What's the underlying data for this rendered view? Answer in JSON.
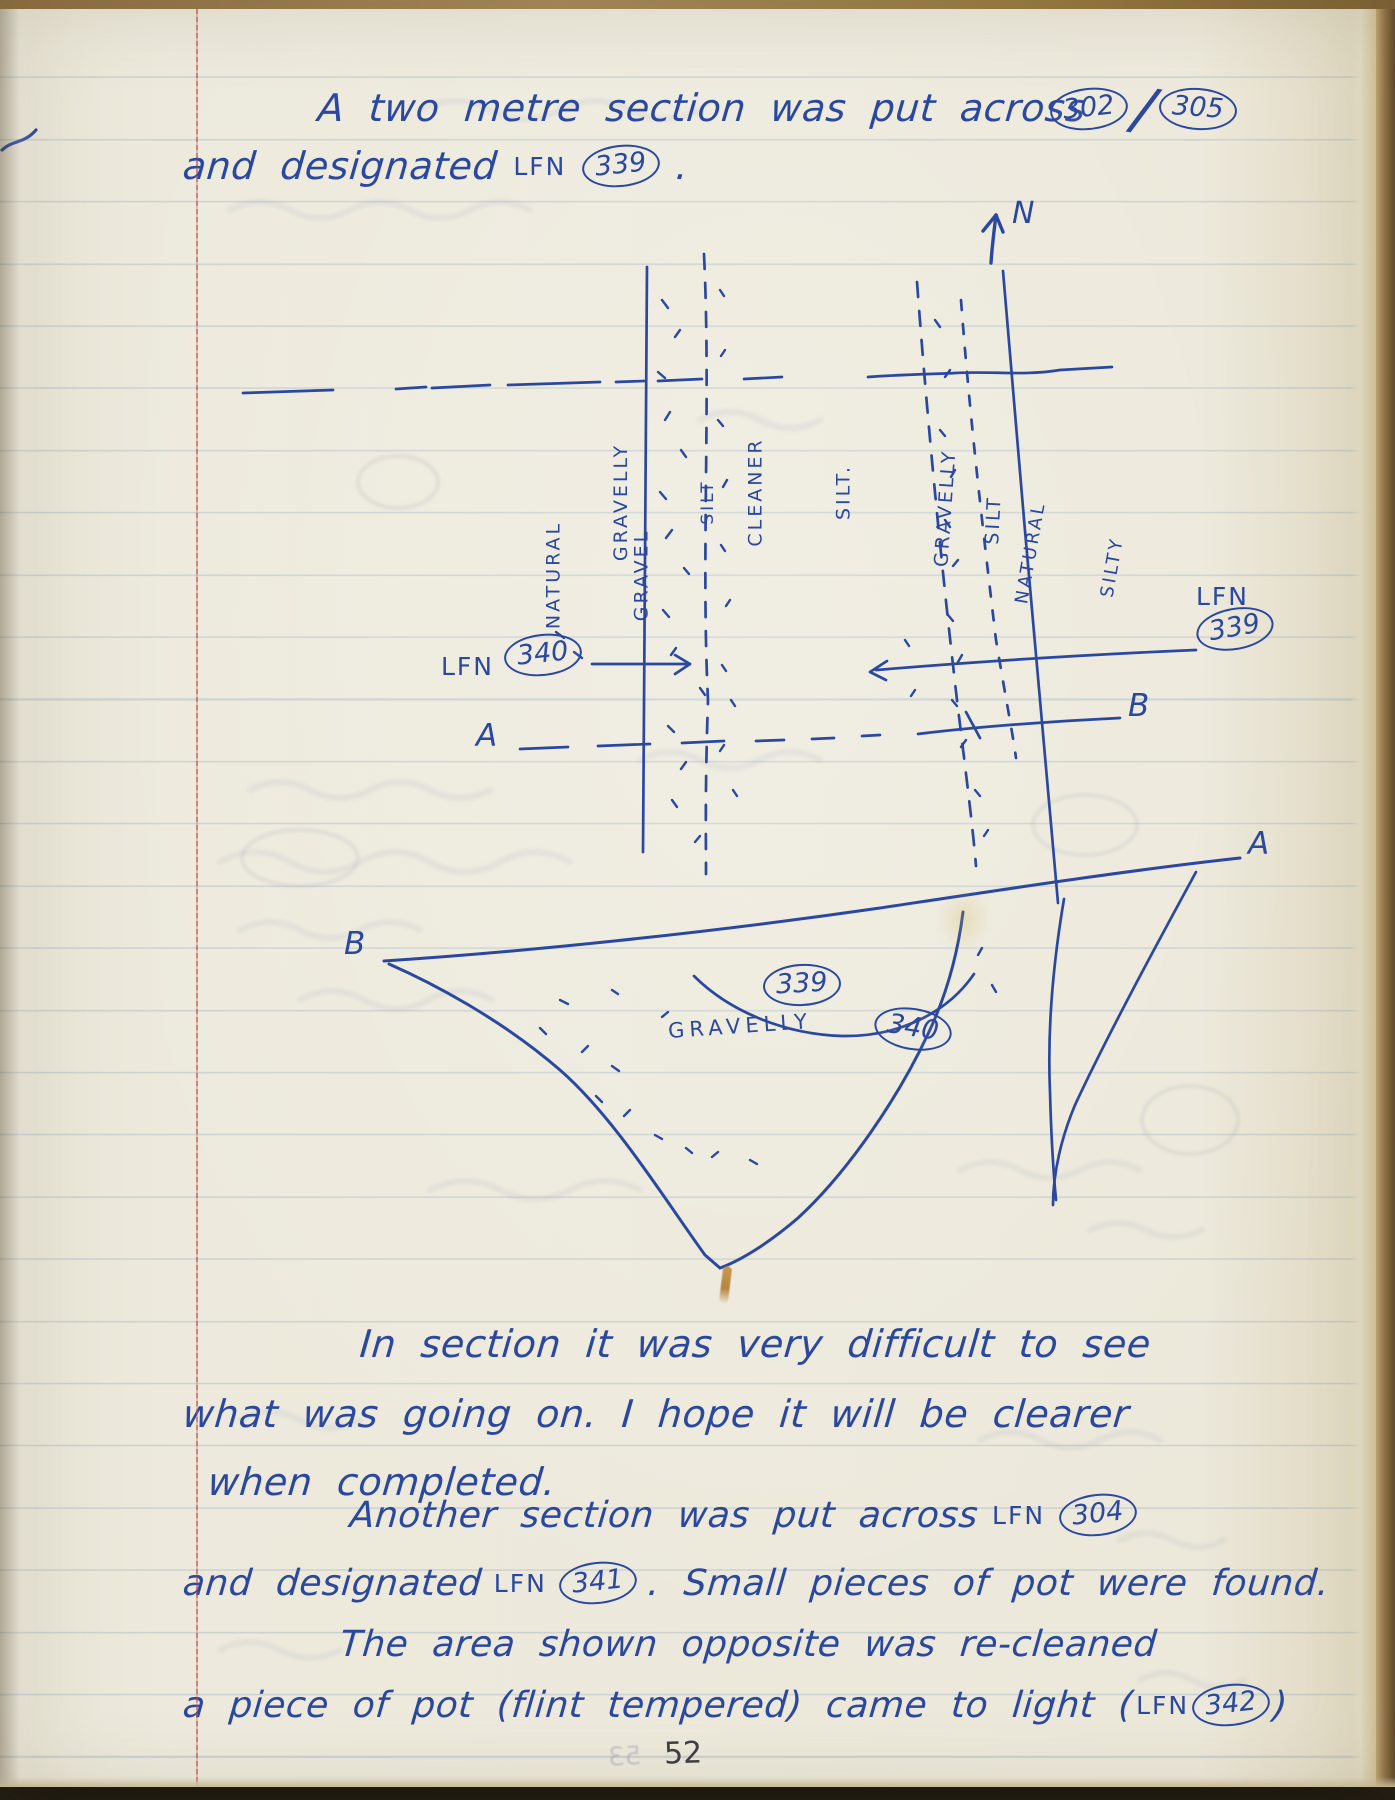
{
  "header": {
    "line1": "A two metre section was put across",
    "ref_a": "302",
    "ref_sep": "/",
    "ref_b": "305",
    "line2_pre": "and designated",
    "line2_lfn": "LFN",
    "line2_num": "339",
    "line2_post": "."
  },
  "compass": {
    "label": "N"
  },
  "plan": {
    "bands": [
      {
        "line1": "NATURAL",
        "line2": "GRAVEL"
      },
      {
        "line1": "GRAVELLY",
        "line2": "SILT"
      },
      {
        "line1": "CLEANER",
        "line2": "SILT."
      },
      {
        "line1": "GRAVELLY",
        "line2": ""
      },
      {
        "line1": "SILT",
        "line2": ""
      },
      {
        "line1": "NATURAL",
        "line2": "SILTY"
      }
    ],
    "callout_340": {
      "lfn": "LFN",
      "num": "340"
    },
    "callout_339": {
      "lfn": "LFN",
      "num": "339"
    },
    "marker_a": "A",
    "marker_b": "B"
  },
  "section": {
    "marker_b": "B",
    "marker_a": "A",
    "num_339": "339",
    "num_340": "340",
    "label_gravelly": "GRAVELLY"
  },
  "body": {
    "p1_l1": "In section it was very difficult to see",
    "p1_l2": "what was going on. I hope it will be clearer",
    "p1_l3": "when completed.",
    "p2_l1_text": "Another section was put across",
    "p2_l1_lfn": "LFN",
    "p2_l1_num": "304",
    "p2_l2_pre": "and designated",
    "p2_l2_lfn": "LFN",
    "p2_l2_num": "341",
    "p2_l2_post": ". Small pieces of pot were found.",
    "p2_l3": "The area shown opposite was re-cleaned",
    "p2_l4_pre": "a piece of pot (flint tempered) came to light (",
    "p2_l4_lfn": "LFN",
    "p2_l4_num": "342",
    "p2_l4_post": ")"
  },
  "footer": {
    "page_number": "52",
    "bleed_number": "53"
  }
}
